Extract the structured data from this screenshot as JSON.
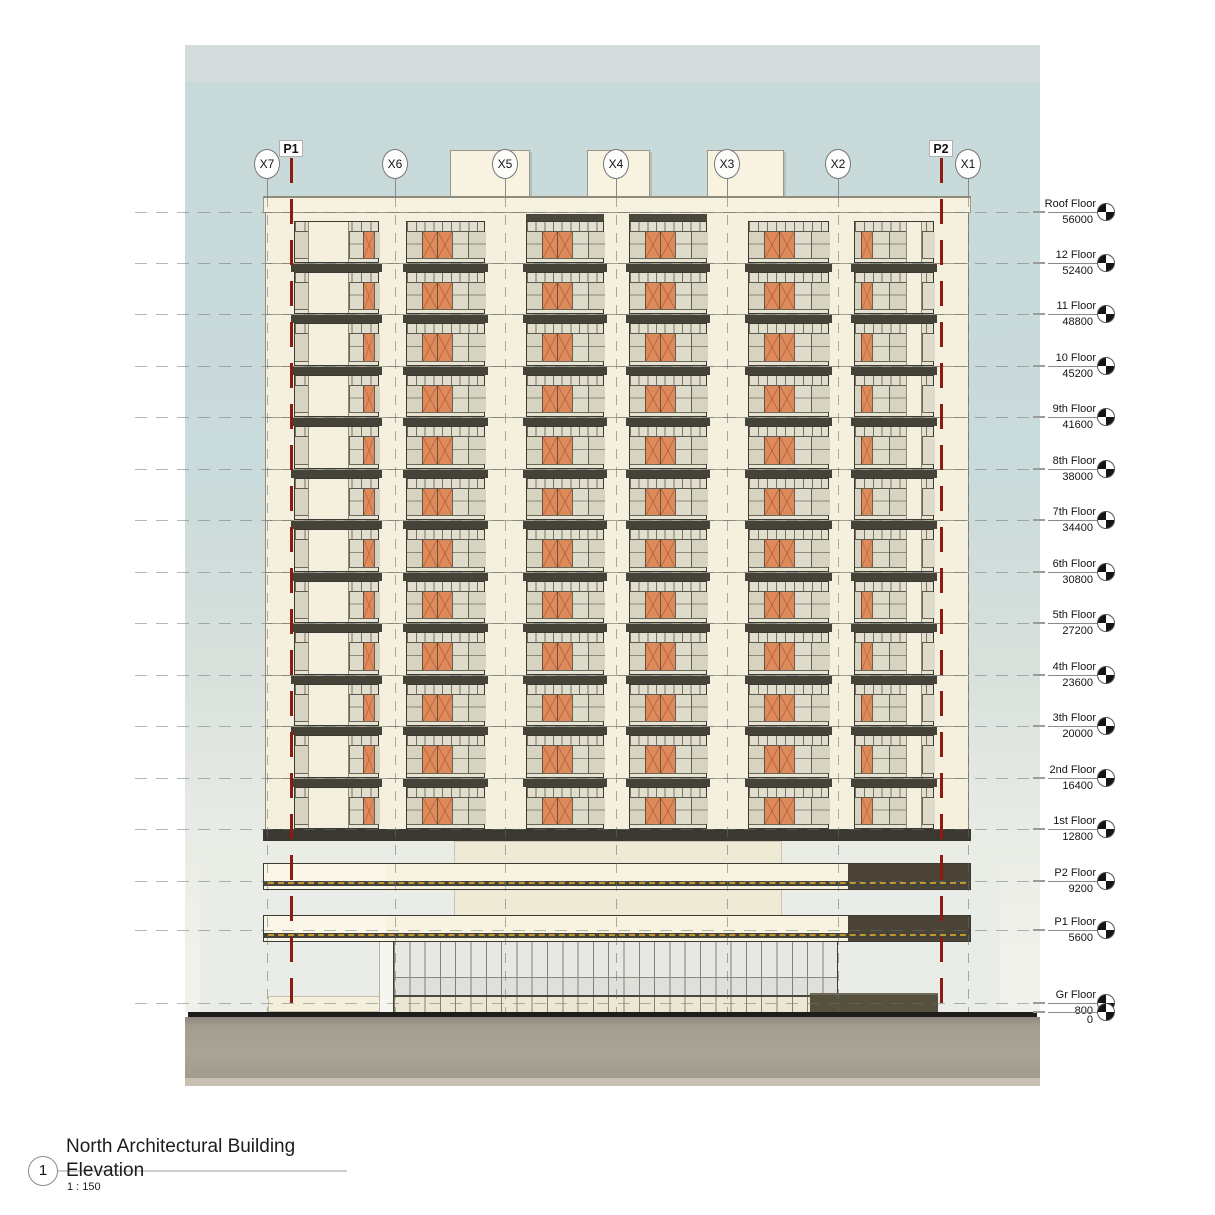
{
  "title_block": {
    "view_number": "1",
    "title_line1": "North Architectural Building",
    "title_line2": "Elevation",
    "scale": "1 : 150"
  },
  "drawing": {
    "grid_bubbles": [
      "X7",
      "X6",
      "X5",
      "X4",
      "X3",
      "X2",
      "X1"
    ],
    "section_markers": [
      "P1",
      "P2"
    ],
    "levels": [
      {
        "label": "Roof Floor",
        "elevation": "56000"
      },
      {
        "label": "12 Floor",
        "elevation": "52400"
      },
      {
        "label": "11 Floor",
        "elevation": "48800"
      },
      {
        "label": "10 Floor",
        "elevation": "45200"
      },
      {
        "label": "9th Floor",
        "elevation": "41600"
      },
      {
        "label": "8th Floor",
        "elevation": "38000"
      },
      {
        "label": "7th Floor",
        "elevation": "34400"
      },
      {
        "label": "6th Floor",
        "elevation": "30800"
      },
      {
        "label": "5th Floor",
        "elevation": "27200"
      },
      {
        "label": "4th Floor",
        "elevation": "23600"
      },
      {
        "label": "3th Floor",
        "elevation": "20000"
      },
      {
        "label": "2nd Floor",
        "elevation": "16400"
      },
      {
        "label": "1st Floor",
        "elevation": "12800"
      },
      {
        "label": "P2 Floor",
        "elevation": "9200"
      },
      {
        "label": "P1 Floor",
        "elevation": "5600"
      },
      {
        "label": "Gr Floor",
        "elevation": "800"
      },
      {
        "label": "",
        "elevation": "0"
      }
    ]
  },
  "colors": {
    "sky": "#cadbdb",
    "facade_cream": "#f5f0dd",
    "glazing": "#dcd8c7",
    "window_orange": "#df8a5a",
    "mullion": "#5d5a4f",
    "slab_dark": "#454238",
    "frame_dark": "#3b3933",
    "podium_dark_panel": "#4a4336",
    "guardrail_yellow": "#cfa32a",
    "section_line_red": "#8e1a10",
    "ground": "#a8a296"
  }
}
